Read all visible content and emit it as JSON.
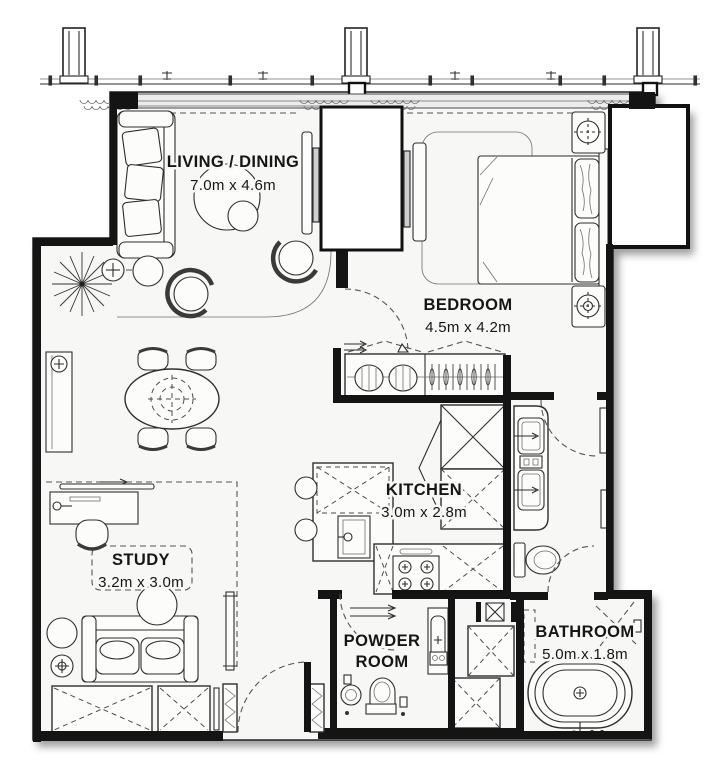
{
  "plan": {
    "title": "Apartment floor plan",
    "rooms": [
      {
        "id": "living-dining",
        "label_lines": [
          "LIVING / DINING"
        ],
        "dimensions": "7.0m x 4.6m"
      },
      {
        "id": "bedroom",
        "label_lines": [
          "BEDROOM"
        ],
        "dimensions": "4.5m x 4.2m"
      },
      {
        "id": "kitchen",
        "label_lines": [
          "KITCHEN"
        ],
        "dimensions": "3.0m x 2.8m"
      },
      {
        "id": "study",
        "label_lines": [
          "STUDY"
        ],
        "dimensions": "3.2m x 3.0m"
      },
      {
        "id": "powder-room",
        "label_lines": [
          "POWDER",
          "ROOM"
        ],
        "dimensions": ""
      },
      {
        "id": "bathroom",
        "label_lines": [
          "BATHROOM"
        ],
        "dimensions": "5.0m x 1.8m"
      }
    ],
    "colors": {
      "wall": "#141414",
      "floor": "#f7f7f6",
      "line": "#2e2e2e",
      "shadow": "rgba(0,0,0,0.38)"
    }
  }
}
